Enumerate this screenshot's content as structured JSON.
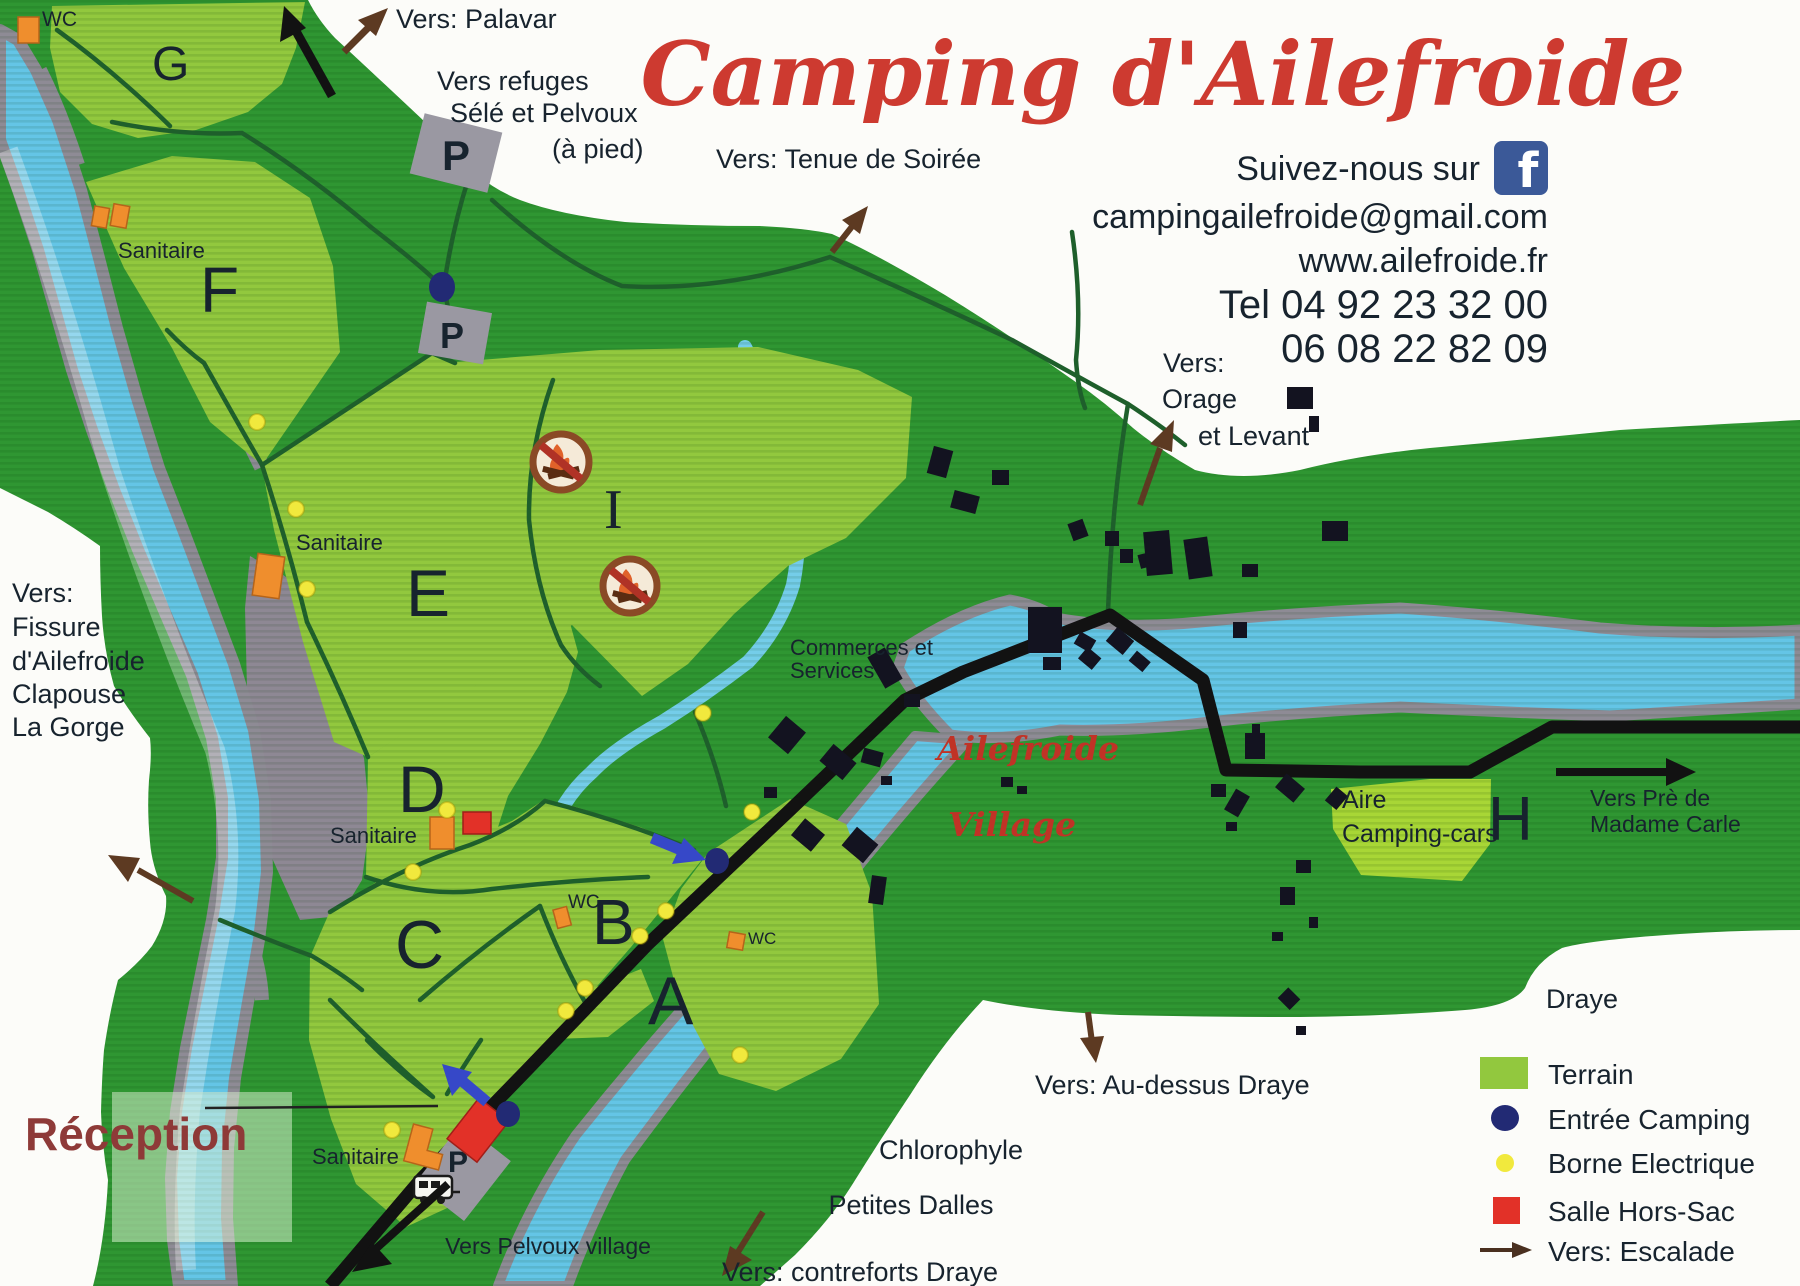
{
  "title": "Camping d'Ailefroide",
  "contact": {
    "follow": "Suivez-nous sur",
    "facebook_f": "f",
    "email": "campingailefroide@gmail.com",
    "website": "www.ailefroide.fr",
    "phone1": "Tel 04 92 23 32 00",
    "phone2": "06 08 22 82 09"
  },
  "zones": {
    "a": "A",
    "b": "B",
    "c": "C",
    "d": "D",
    "e": "E",
    "f": "F",
    "g": "G",
    "h": "H",
    "i": "I"
  },
  "labels": {
    "reception": "Réception",
    "sanitaire": "Sanitaire",
    "wc": "WC",
    "parking": "P",
    "commerces_line1": "Commerces et",
    "commerces_line2": "Services",
    "village_line1": "Ailefroide",
    "village_line2": "Village",
    "aire_line1": "Aire",
    "aire_line2": "Camping-cars",
    "draye": "Draye",
    "chlorophyle": "Chlorophyle",
    "petites_dalles": "Petites Dalles"
  },
  "directions": {
    "palavar": "Vers: Palavar",
    "refuges_line1": "Vers refuges",
    "refuges_line2": "Sélé et Pelvoux",
    "refuges_line3": "(à pied)",
    "tenue": "Vers: Tenue de Soirée",
    "orage_line1": "Vers:",
    "orage_line2": "Orage",
    "orage_line3": "et Levant",
    "fissure_line1": "Vers:",
    "fissure_line2": "Fissure",
    "fissure_line3": "d'Ailefroide",
    "fissure_line4": "Clapouse",
    "fissure_line5": "La Gorge",
    "pre_line1": "Vers Prè de",
    "pre_line2": "Madame Carle",
    "au_dessus": "Vers: Au-dessus Draye",
    "contreforts": "Vers: contreforts Draye",
    "pelvoux": "Vers Pelvoux village"
  },
  "legend": {
    "terrain": "Terrain",
    "entree": "Entrée Camping",
    "borne": "Borne Electrique",
    "salle": "Salle Hors-Sac",
    "escalade": "Vers: Escalade"
  },
  "colors": {
    "terrain_light": "#92c83e",
    "terrain_dark": "#2f9632",
    "river": "#64c5e6",
    "entree_camping": "#222a74",
    "borne_electrique": "#f1e93d",
    "salle_hors_sac": "#e23128",
    "arrow_brown": "#5d3a22",
    "facebook_blue": "#3b5998",
    "title_red": "#cd3a30",
    "reception_maroon": "#8e3a38",
    "village_red": "#c03326"
  }
}
